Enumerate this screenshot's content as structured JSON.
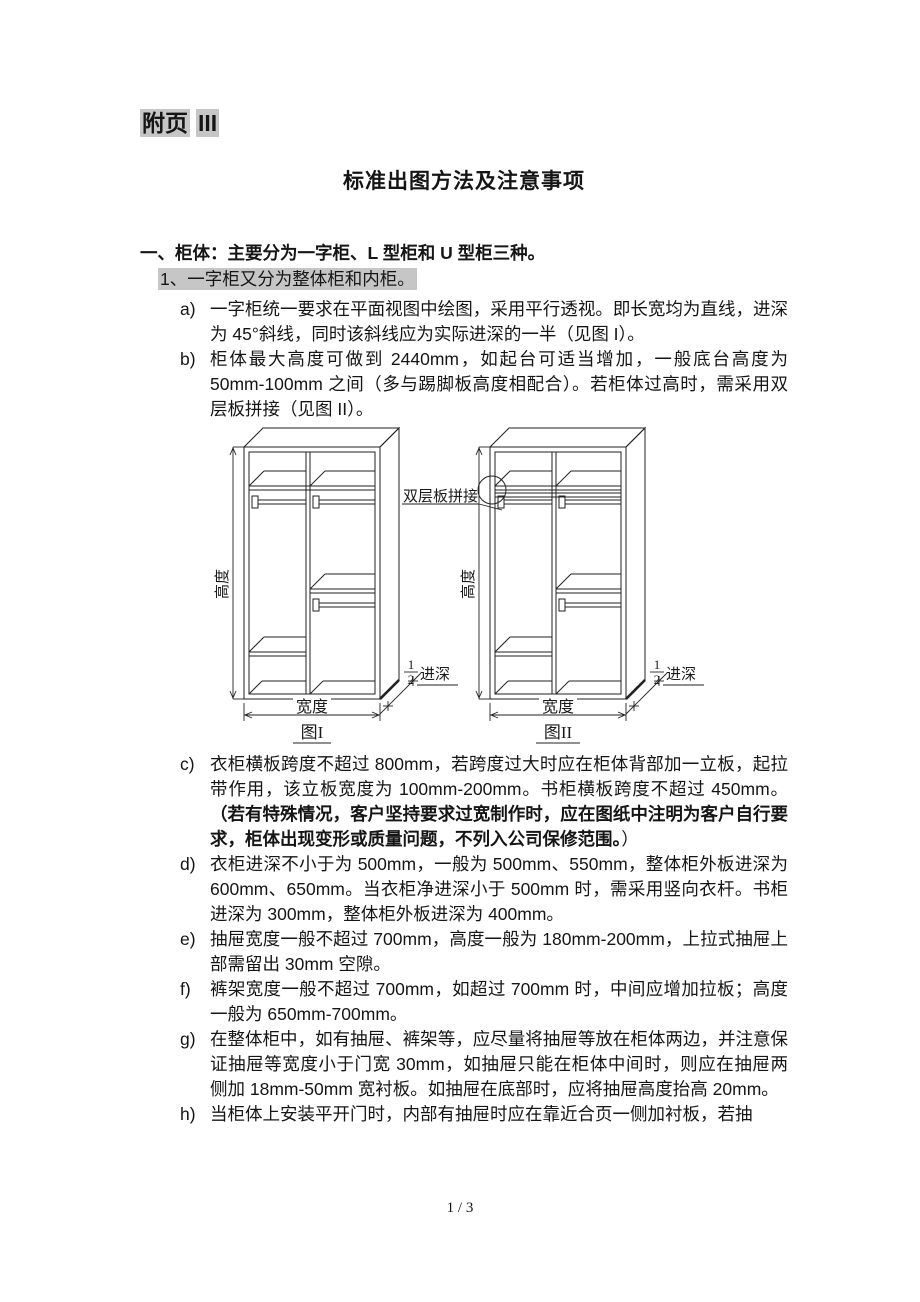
{
  "header": {
    "appendix_prefix": "附页",
    "appendix_number": "III",
    "title": "标准出图方法及注意事项"
  },
  "section": {
    "heading": "一、柜体：主要分为一字柜、L 型柜和 U 型柜三种。",
    "subheading": "1、一字柜又分为整体柜和内柜。"
  },
  "list": {
    "items": [
      {
        "marker": "a)",
        "text": "一字柜统一要求在平面视图中绘图，采用平行透视。即长宽均为直线，进深为 45°斜线，同时该斜线应为实际进深的一半（见图 I）。"
      },
      {
        "marker": "b)",
        "text": "柜体最大高度可做到 2440mm，如起台可适当增加，一般底台高度为 50mm-100mm 之间（多与踢脚板高度相配合）。若柜体过高时，需采用双层板拼接（见图 II）。"
      },
      {
        "marker": "c)",
        "text": "衣柜横板跨度不超过 800mm，若跨度过大时应在柜体背部加一立板，起拉带作用，该立板宽度为 100mm-200mm。书柜横板跨度不超过 450mm。",
        "bold_text": "（若有特殊情况，客户坚持要求过宽制作时，应在图纸中注明为客户自行要求，柜体出现变形或质量问题，不列入公司保修范围。",
        "close_text": "）"
      },
      {
        "marker": "d)",
        "text": "衣柜进深不小于为 500mm，一般为 500mm、550mm，整体柜外板进深为 600mm、650mm。当衣柜净进深小于 500mm 时，需采用竖向衣杆。书柜进深为 300mm，整体柜外板进深为 400mm。"
      },
      {
        "marker": "e)",
        "text": "抽屉宽度一般不超过 700mm，高度一般为 180mm-200mm，上拉式抽屉上部需留出 30mm 空隙。"
      },
      {
        "marker": "f)",
        "text": "裤架宽度一般不超过 700mm，如超过 700mm 时，中间应增加拉板；高度一般为 650mm-700mm。"
      },
      {
        "marker": "g)",
        "text": "在整体柜中，如有抽屉、裤架等，应尽量将抽屉等放在柜体两边，并注意保证抽屉等宽度小于门宽 30mm，如抽屉只能在柜体中间时，则应在抽屉两侧加 18mm-50mm 宽衬板。如抽屉在底部时，应将抽屉高度抬高 20mm。"
      },
      {
        "marker": "h)",
        "text": "当柜体上安装平开门时，内部有抽屉时应在靠近合页一侧加衬板，若抽"
      }
    ]
  },
  "figure": {
    "joint_label": "双层板拼接",
    "height_label": "高度",
    "width_label": "宽度",
    "half_depth_numerator": "1",
    "half_depth_denominator": "2",
    "half_depth_suffix": "进深",
    "fig1_caption": "图I",
    "fig2_caption": "图II"
  },
  "footer": {
    "page_indicator": "1 / 3"
  }
}
